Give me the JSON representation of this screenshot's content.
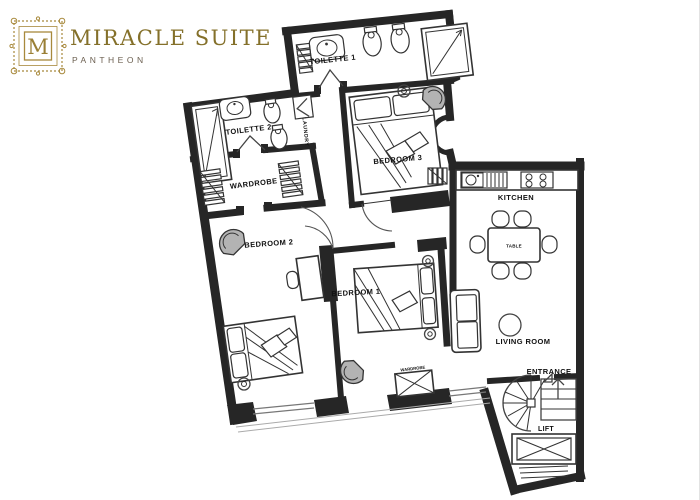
{
  "brand": {
    "monogram": "M",
    "title": "MIRACLE SUITE",
    "subtitle": "PANTHEON"
  },
  "colors": {
    "gold": "#A8893C",
    "wall": "#262626",
    "label_text": "#111111",
    "chair_shade": "#B3B3B3"
  },
  "labels": {
    "toilette1": "TOILETTE 1",
    "toilette2": "TOILETTE 2",
    "laundry": "LAUNDRY",
    "wardrobe_room": "WARDROBE",
    "bedroom1": "BEDROOM 1",
    "bedroom2": "BEDROOM 2",
    "bedroom3": "BEDROOM 3",
    "kitchen": "KITCHEN",
    "table": "TABLE",
    "living_room": "LIVING ROOM",
    "entrance": "ENTRANCE",
    "lift": "LIFT",
    "wardrobe_unit": "WARDROBE"
  }
}
